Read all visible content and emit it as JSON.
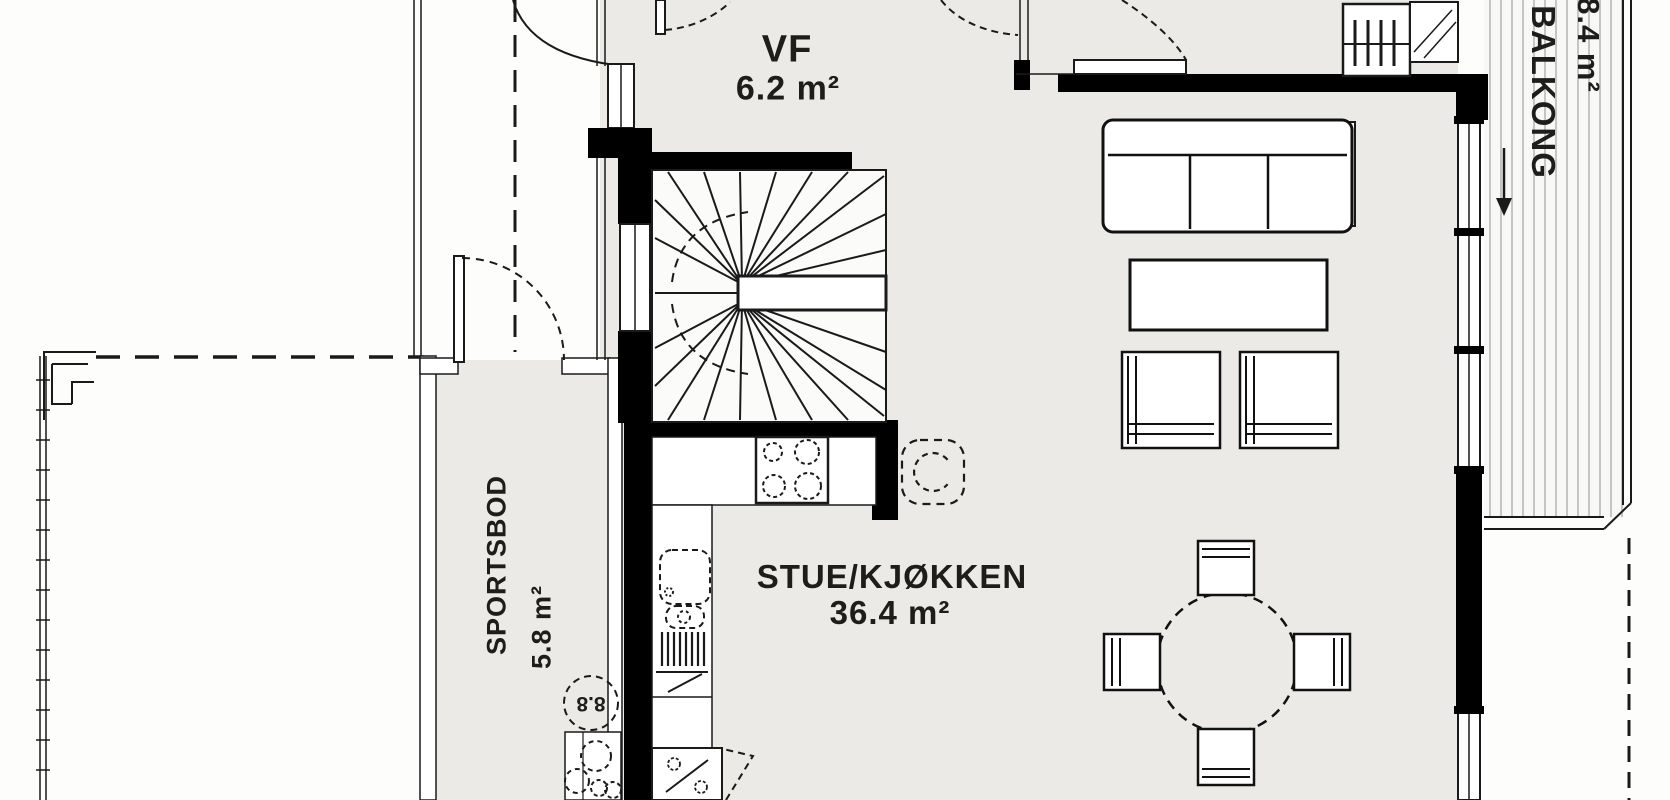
{
  "floorplan": {
    "rooms": {
      "vf": {
        "label": "VF",
        "area": "6.2 m²"
      },
      "stue_kjokken": {
        "label": "STUE/KJØKKEN",
        "area": "36.4 m²"
      },
      "sportsbod": {
        "label": "SPORTSBOD",
        "area": "5.8 m²"
      },
      "balkong": {
        "label": "BALKONG",
        "area": "8.4 m²"
      }
    },
    "markers": {
      "circle_label": "8.8"
    },
    "colors": {
      "floor": "#eceae6",
      "wall": "#000000",
      "line": "#1a1a1a",
      "outside": "#fdfdfc",
      "deck_stripe": "#c6c5c1"
    }
  }
}
